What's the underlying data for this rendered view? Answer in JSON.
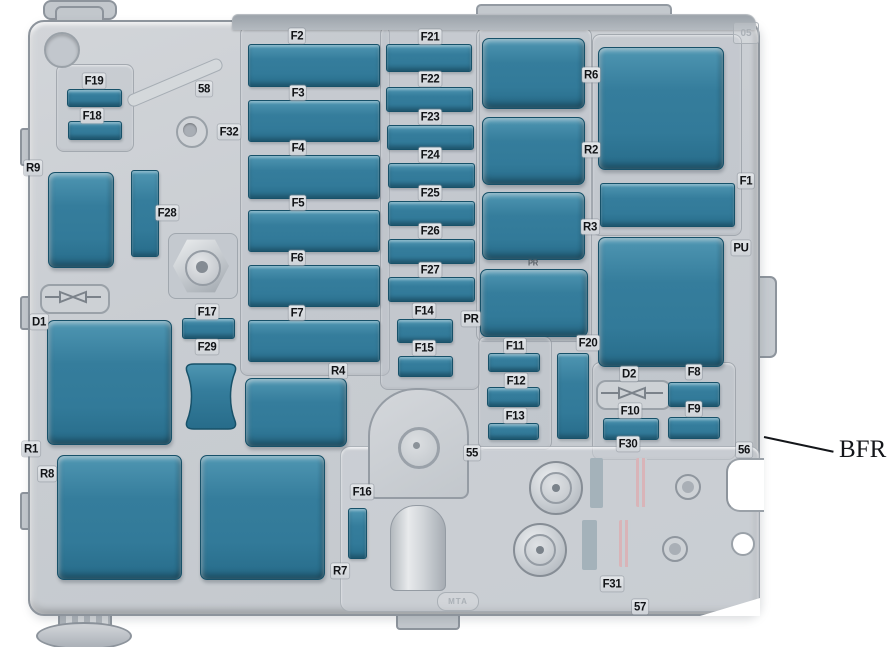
{
  "figure": {
    "title": "engine-compartment-fuse-box-diagram",
    "width": 888,
    "height": 647
  },
  "palette": {
    "component_fill": "#357d9c",
    "component_border": "#175169",
    "body_gray": "#c9cdd2",
    "label_color": "#111316"
  },
  "callout": {
    "text": "BFR"
  },
  "embossed": {
    "logo": "MTA",
    "corner_mark": "05"
  },
  "components": [
    {
      "id": "F19",
      "kind": "fuse",
      "x": 67,
      "y": 89,
      "w": 53,
      "h": 16
    },
    {
      "id": "F18",
      "kind": "fuse",
      "x": 68,
      "y": 121,
      "w": 52,
      "h": 17
    },
    {
      "id": "R9",
      "kind": "relay",
      "x": 48,
      "y": 172,
      "w": 64,
      "h": 94
    },
    {
      "id": "F28",
      "kind": "fuse",
      "x": 131,
      "y": 170,
      "w": 26,
      "h": 85
    },
    {
      "id": "D1",
      "kind": "relay",
      "x": 47,
      "y": 320,
      "w": 123,
      "h": 123
    },
    {
      "id": "R8",
      "kind": "relay",
      "x": 57,
      "y": 455,
      "w": 123,
      "h": 123
    },
    {
      "id": "R7",
      "kind": "relay",
      "x": 200,
      "y": 455,
      "w": 123,
      "h": 123
    },
    {
      "id": "F17",
      "kind": "fuse",
      "x": 182,
      "y": 318,
      "w": 51,
      "h": 19
    },
    {
      "id": "F29",
      "kind": "hourglass",
      "x": 185,
      "y": 363,
      "w": 52,
      "h": 67
    },
    {
      "id": "R4",
      "kind": "relay",
      "x": 245,
      "y": 378,
      "w": 100,
      "h": 67
    },
    {
      "id": "F16",
      "kind": "fuse",
      "x": 348,
      "y": 508,
      "w": 17,
      "h": 49
    },
    {
      "id": "F2",
      "kind": "fuse",
      "x": 248,
      "y": 44,
      "w": 130,
      "h": 41
    },
    {
      "id": "F3",
      "kind": "fuse",
      "x": 248,
      "y": 100,
      "w": 130,
      "h": 40
    },
    {
      "id": "F4",
      "kind": "fuse",
      "x": 248,
      "y": 155,
      "w": 130,
      "h": 42
    },
    {
      "id": "F5",
      "kind": "fuse",
      "x": 248,
      "y": 210,
      "w": 130,
      "h": 40
    },
    {
      "id": "F6",
      "kind": "fuse",
      "x": 248,
      "y": 265,
      "w": 130,
      "h": 40
    },
    {
      "id": "F7",
      "kind": "fuse",
      "x": 248,
      "y": 320,
      "w": 130,
      "h": 40
    },
    {
      "id": "F21",
      "kind": "fuse",
      "x": 386,
      "y": 44,
      "w": 84,
      "h": 26
    },
    {
      "id": "F22",
      "kind": "fuse",
      "x": 386,
      "y": 87,
      "w": 85,
      "h": 23
    },
    {
      "id": "F23",
      "kind": "fuse",
      "x": 387,
      "y": 125,
      "w": 85,
      "h": 23
    },
    {
      "id": "F24",
      "kind": "fuse",
      "x": 388,
      "y": 163,
      "w": 85,
      "h": 23
    },
    {
      "id": "F25",
      "kind": "fuse",
      "x": 388,
      "y": 201,
      "w": 85,
      "h": 23
    },
    {
      "id": "F26",
      "kind": "fuse",
      "x": 388,
      "y": 239,
      "w": 85,
      "h": 23
    },
    {
      "id": "F27",
      "kind": "fuse",
      "x": 388,
      "y": 277,
      "w": 85,
      "h": 23
    },
    {
      "id": "F14",
      "kind": "fuse",
      "x": 397,
      "y": 319,
      "w": 54,
      "h": 22
    },
    {
      "id": "F15",
      "kind": "fuse",
      "x": 398,
      "y": 356,
      "w": 53,
      "h": 19
    },
    {
      "id": "R6",
      "kind": "relay",
      "x": 482,
      "y": 38,
      "w": 101,
      "h": 69
    },
    {
      "id": "R2",
      "kind": "relay",
      "x": 482,
      "y": 117,
      "w": 101,
      "h": 66
    },
    {
      "id": "R3",
      "kind": "relay",
      "x": 482,
      "y": 192,
      "w": 101,
      "h": 66
    },
    {
      "id": "PR",
      "kind": "relay",
      "x": 480,
      "y": 269,
      "w": 106,
      "h": 66
    },
    {
      "id": "large-relay-upper",
      "kind": "relay",
      "x": 598,
      "y": 47,
      "w": 124,
      "h": 121
    },
    {
      "id": "F1",
      "kind": "fuse",
      "x": 600,
      "y": 183,
      "w": 133,
      "h": 42
    },
    {
      "id": "large-relay-lower",
      "kind": "relay",
      "x": 598,
      "y": 237,
      "w": 124,
      "h": 128
    },
    {
      "id": "F20",
      "kind": "fuse",
      "x": 557,
      "y": 353,
      "w": 30,
      "h": 84
    },
    {
      "id": "F11",
      "kind": "fuse",
      "x": 488,
      "y": 353,
      "w": 50,
      "h": 17
    },
    {
      "id": "F12",
      "kind": "fuse",
      "x": 487,
      "y": 387,
      "w": 51,
      "h": 18
    },
    {
      "id": "F13",
      "kind": "fuse",
      "x": 488,
      "y": 423,
      "w": 49,
      "h": 15
    },
    {
      "id": "F8",
      "kind": "fuse",
      "x": 668,
      "y": 382,
      "w": 50,
      "h": 23
    },
    {
      "id": "F9",
      "kind": "fuse",
      "x": 668,
      "y": 417,
      "w": 50,
      "h": 20
    },
    {
      "id": "F10",
      "kind": "fuse",
      "x": 603,
      "y": 418,
      "w": 54,
      "h": 20
    }
  ],
  "labels": [
    {
      "text": "F19",
      "x": 94,
      "y": 81
    },
    {
      "text": "F18",
      "x": 92,
      "y": 116
    },
    {
      "text": "58",
      "x": 204,
      "y": 89
    },
    {
      "text": "F32",
      "x": 229,
      "y": 132
    },
    {
      "text": "R9",
      "x": 33,
      "y": 168
    },
    {
      "text": "F28",
      "x": 167,
      "y": 213
    },
    {
      "text": "F17",
      "x": 207,
      "y": 312
    },
    {
      "text": "F29",
      "x": 207,
      "y": 347
    },
    {
      "text": "D1",
      "x": 39,
      "y": 322
    },
    {
      "text": "R1",
      "x": 31,
      "y": 449
    },
    {
      "text": "R8",
      "x": 47,
      "y": 474
    },
    {
      "text": "R4",
      "x": 338,
      "y": 371
    },
    {
      "text": "R7",
      "x": 340,
      "y": 571
    },
    {
      "text": "F16",
      "x": 362,
      "y": 492
    },
    {
      "text": "F2",
      "x": 297,
      "y": 36
    },
    {
      "text": "F3",
      "x": 298,
      "y": 93
    },
    {
      "text": "F4",
      "x": 298,
      "y": 148
    },
    {
      "text": "F5",
      "x": 298,
      "y": 203
    },
    {
      "text": "F6",
      "x": 297,
      "y": 258
    },
    {
      "text": "F7",
      "x": 297,
      "y": 313
    },
    {
      "text": "F21",
      "x": 430,
      "y": 37
    },
    {
      "text": "F22",
      "x": 430,
      "y": 79
    },
    {
      "text": "F23",
      "x": 430,
      "y": 117
    },
    {
      "text": "F24",
      "x": 430,
      "y": 155
    },
    {
      "text": "F25",
      "x": 430,
      "y": 193
    },
    {
      "text": "F26",
      "x": 430,
      "y": 231
    },
    {
      "text": "F27",
      "x": 430,
      "y": 270
    },
    {
      "text": "F14",
      "x": 424,
      "y": 311
    },
    {
      "text": "F15",
      "x": 424,
      "y": 348
    },
    {
      "text": "R6",
      "x": 591,
      "y": 75
    },
    {
      "text": "R2",
      "x": 591,
      "y": 150
    },
    {
      "text": "R3",
      "x": 590,
      "y": 227
    },
    {
      "text": "F1",
      "x": 746,
      "y": 181
    },
    {
      "text": "PU",
      "x": 741,
      "y": 248
    },
    {
      "text": "PR",
      "x": 471,
      "y": 319
    },
    {
      "text": "PR",
      "x": 533,
      "y": 264,
      "small": true
    },
    {
      "text": "F20",
      "x": 588,
      "y": 343
    },
    {
      "text": "F11",
      "x": 515,
      "y": 346
    },
    {
      "text": "F12",
      "x": 516,
      "y": 381
    },
    {
      "text": "F13",
      "x": 515,
      "y": 416
    },
    {
      "text": "D2",
      "x": 629,
      "y": 374
    },
    {
      "text": "F8",
      "x": 694,
      "y": 372
    },
    {
      "text": "F10",
      "x": 630,
      "y": 411
    },
    {
      "text": "F9",
      "x": 694,
      "y": 409
    },
    {
      "text": "F30",
      "x": 628,
      "y": 444
    },
    {
      "text": "55",
      "x": 472,
      "y": 453
    },
    {
      "text": "56",
      "x": 744,
      "y": 450
    },
    {
      "text": "F31",
      "x": 612,
      "y": 584
    },
    {
      "text": "57",
      "x": 640,
      "y": 607
    }
  ]
}
